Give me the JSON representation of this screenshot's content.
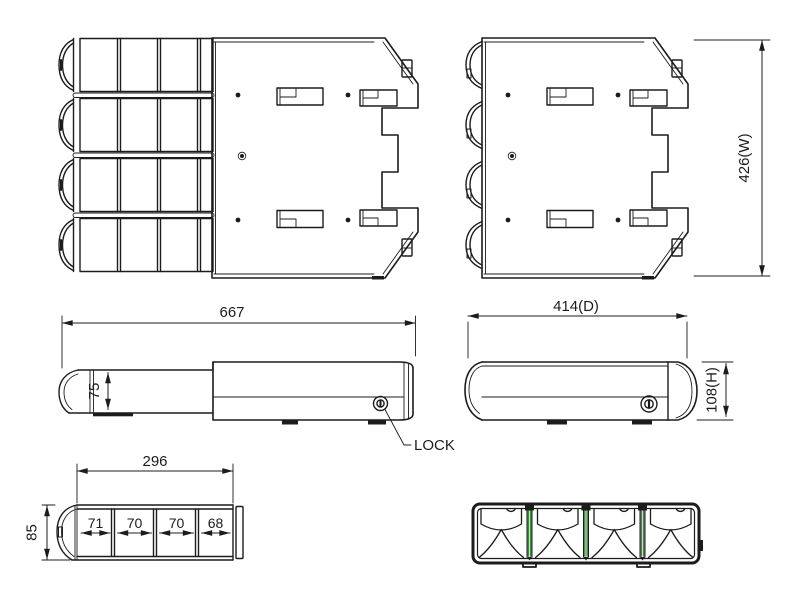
{
  "colors": {
    "line": "#1c1c1c",
    "accent_green": "#3f8e3f",
    "background": "#ffffff"
  },
  "dimensions": {
    "top_view_width": "426(W)",
    "side_open_length": "667",
    "side_open_drawer_height": "75",
    "side_depth": "414(D)",
    "side_height": "108(H)",
    "drawer_front_width": "296",
    "drawer_front_height": "85",
    "drawer_cell_widths": [
      "71",
      "70",
      "70",
      "68"
    ]
  },
  "labels": {
    "lock": "LOCK"
  }
}
